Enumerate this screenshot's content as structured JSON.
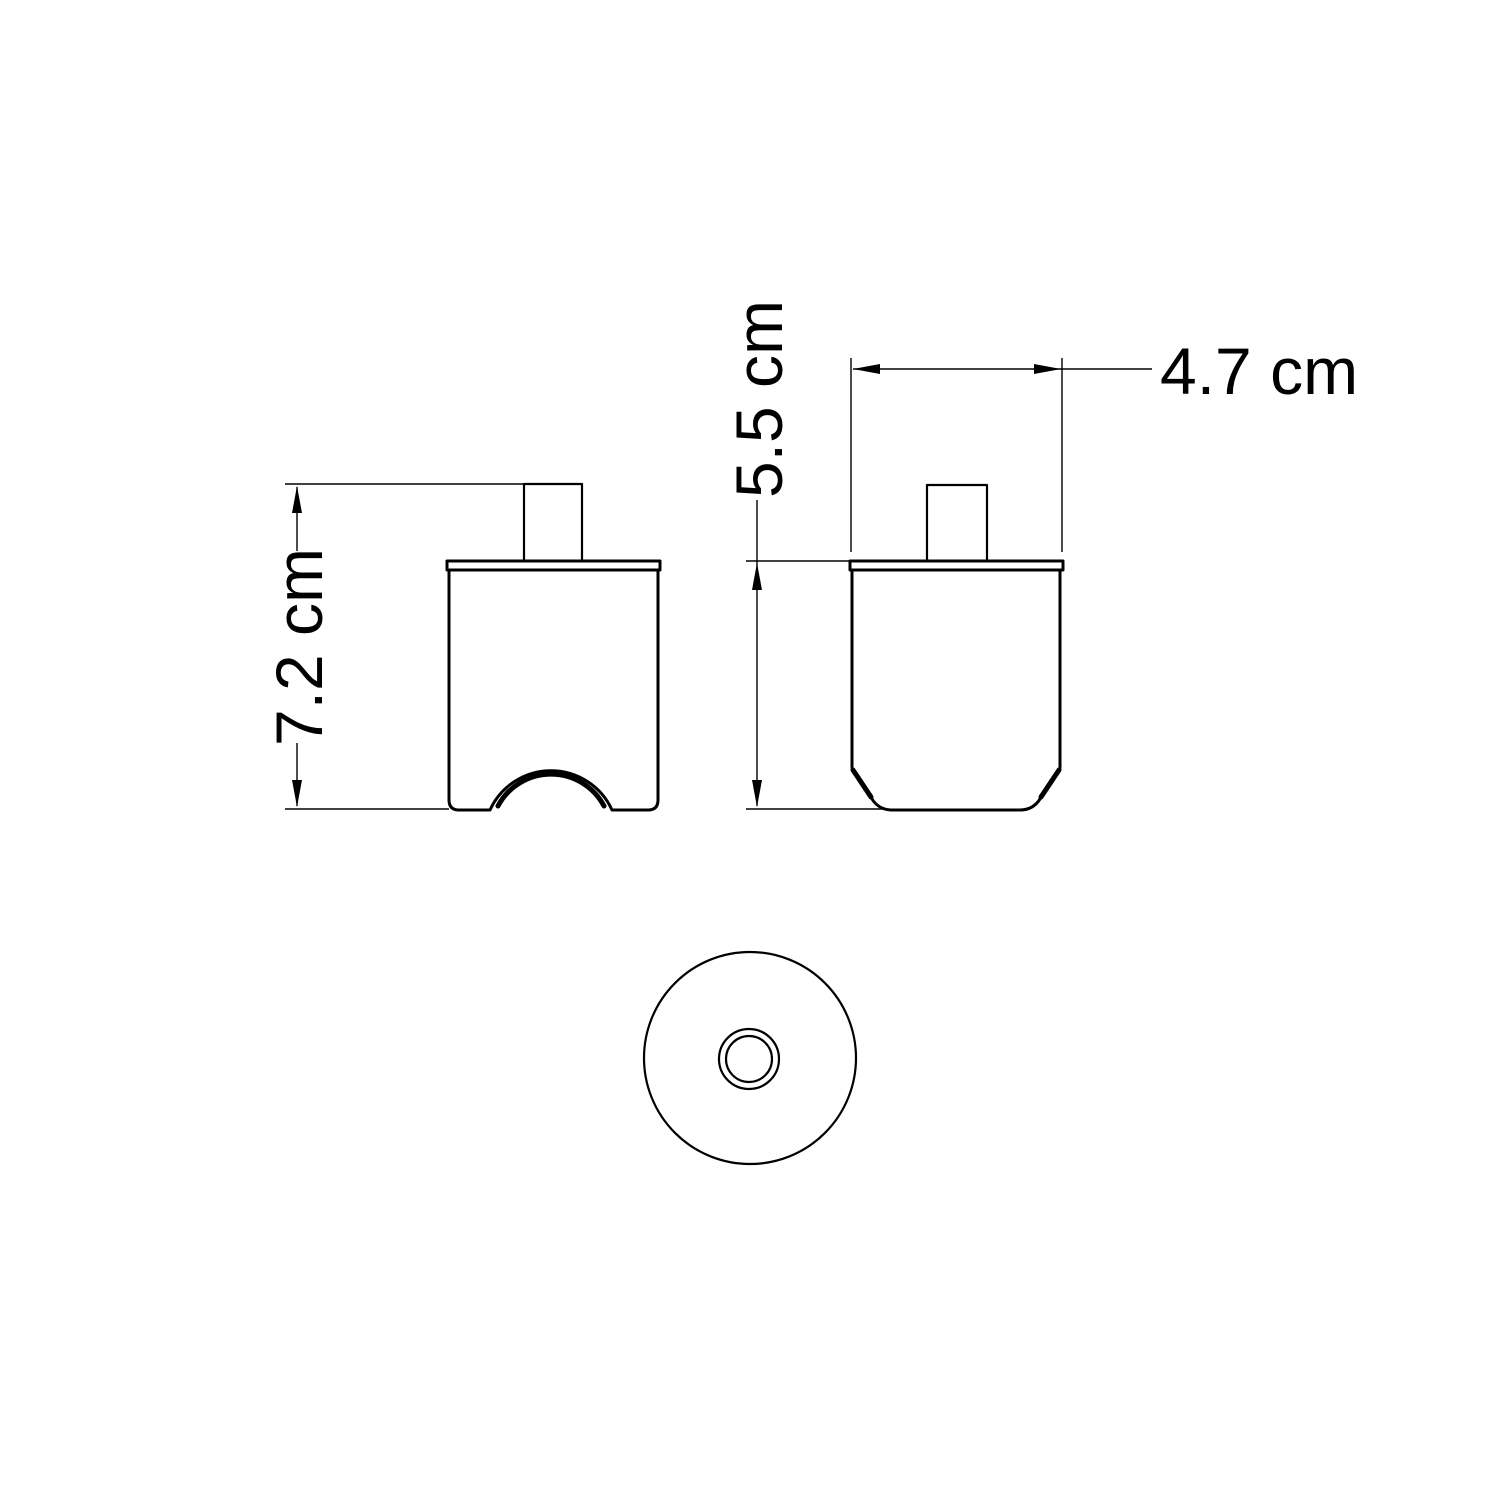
{
  "drawing": {
    "type": "technical-dimension-drawing",
    "views": {
      "front": "front elevation with bottom cable arch",
      "side": "side elevation with chamfered base",
      "top": "top view with concentric hole circles"
    }
  },
  "dimensions": {
    "total_height": {
      "label": "7.2 cm",
      "value": 7.2,
      "unit": "cm",
      "orientation": "vertical"
    },
    "body_height": {
      "label": "5.5 cm",
      "value": 5.5,
      "unit": "cm",
      "orientation": "vertical"
    },
    "top_width": {
      "label": "4.7 cm",
      "value": 4.7,
      "unit": "cm",
      "orientation": "horizontal"
    }
  },
  "colors": {
    "background": "#ffffff",
    "line": "#000000",
    "text": "#000000"
  }
}
